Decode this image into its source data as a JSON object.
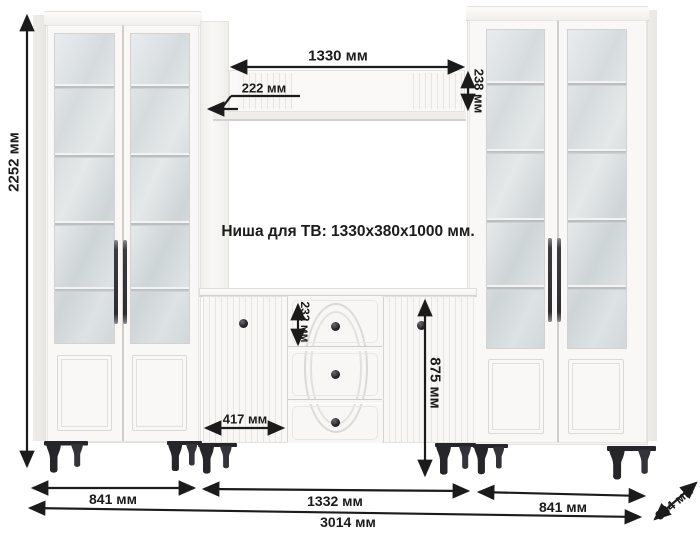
{
  "diagram": {
    "niche_note": "Ниша для ТВ: 1330x380x1000 мм.",
    "dimensions": {
      "total_height": "2252 мм",
      "shelf_width": "1330 мм",
      "shelf_depth": "222 мм",
      "shelf_panel_height": "238 мм",
      "top_drawer_height": "232 мм",
      "commode_door_width": "417 мм",
      "commode_height": "875 мм",
      "left_cabinet_width": "841 мм",
      "commode_width": "1332 мм",
      "right_cabinet_width": "841 мм",
      "total_width": "3014 мм",
      "unit_depth": "384 мм"
    },
    "colors": {
      "dimension_line": "#1b1b1b",
      "furniture": "#f8f7f5",
      "glass": "#d9dfe1",
      "legs": "#26262a"
    }
  }
}
